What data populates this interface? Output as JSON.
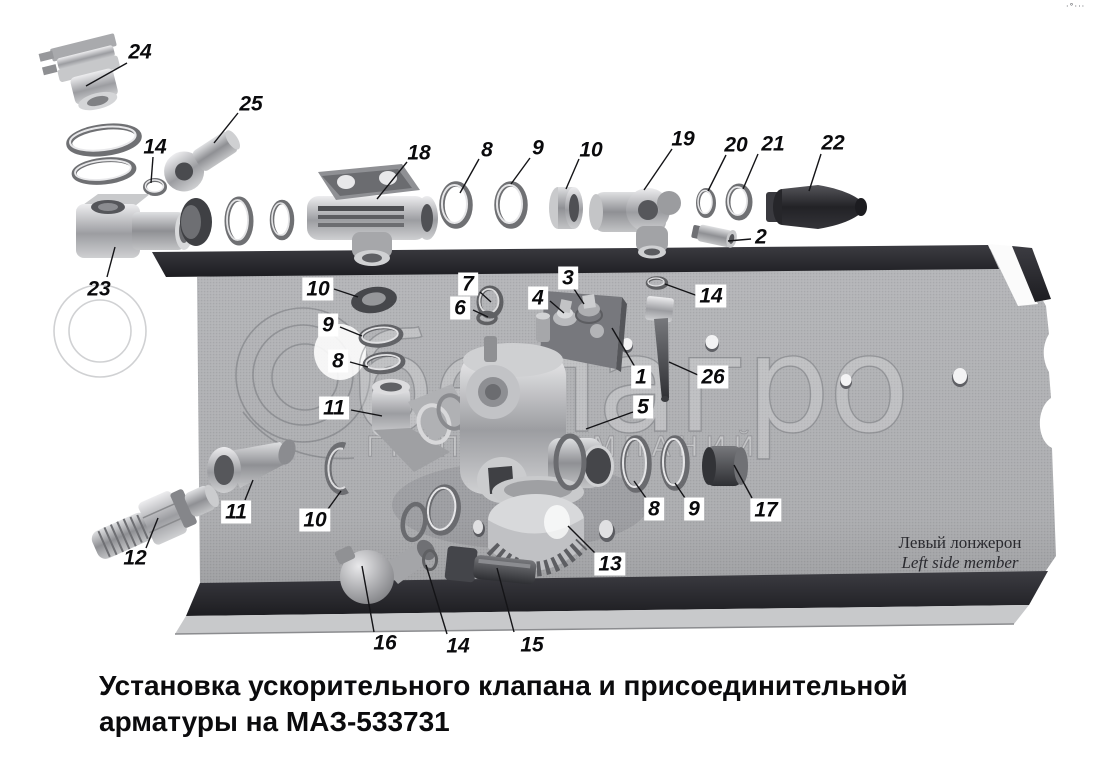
{
  "caption": {
    "line1": "Установка ускорительного клапана и присоединительной",
    "line2": "арматуры на МАЗ-533731"
  },
  "beam_label": {
    "ru": "Левый лонжерон",
    "en": "Left side member"
  },
  "watermark": {
    "brand": "белагро",
    "subtitle": "ГРУППА КОМПАНИЙ"
  },
  "corner_mark": "·°···",
  "callouts": [
    {
      "n": "24",
      "x": 140,
      "y": 52,
      "boxed": false,
      "line": [
        127,
        63,
        86,
        86
      ]
    },
    {
      "n": "25",
      "x": 251,
      "y": 104,
      "boxed": false,
      "line": [
        238,
        113,
        214,
        143
      ]
    },
    {
      "n": "14",
      "x": 155,
      "y": 147,
      "boxed": false,
      "line": [
        153,
        157,
        151,
        183
      ]
    },
    {
      "n": "23",
      "x": 99,
      "y": 289,
      "boxed": false,
      "line": [
        107,
        277,
        115,
        247
      ]
    },
    {
      "n": "18",
      "x": 419,
      "y": 153,
      "boxed": false,
      "line": [
        407,
        162,
        377,
        199
      ]
    },
    {
      "n": "8",
      "x": 487,
      "y": 150,
      "boxed": false,
      "line": [
        479,
        159,
        460,
        193
      ]
    },
    {
      "n": "9",
      "x": 538,
      "y": 148,
      "boxed": false,
      "line": [
        530,
        158,
        511,
        184
      ]
    },
    {
      "n": "10",
      "x": 591,
      "y": 150,
      "boxed": false,
      "line": [
        579,
        159,
        566,
        189
      ]
    },
    {
      "n": "19",
      "x": 683,
      "y": 139,
      "boxed": false,
      "line": [
        672,
        149,
        644,
        190
      ]
    },
    {
      "n": "20",
      "x": 736,
      "y": 145,
      "boxed": false,
      "line": [
        726,
        155,
        708,
        191
      ]
    },
    {
      "n": "21",
      "x": 773,
      "y": 144,
      "boxed": false,
      "line": [
        758,
        154,
        743,
        189
      ]
    },
    {
      "n": "22",
      "x": 833,
      "y": 143,
      "boxed": false,
      "line": [
        821,
        154,
        809,
        191
      ]
    },
    {
      "n": "2",
      "x": 761,
      "y": 237,
      "boxed": false,
      "line": [
        751,
        239,
        728,
        241
      ]
    },
    {
      "n": "12",
      "x": 135,
      "y": 558,
      "boxed": false,
      "line": [
        146,
        548,
        158,
        518
      ]
    },
    {
      "n": "16",
      "x": 385,
      "y": 643,
      "boxed": false,
      "line": [
        374,
        632,
        362,
        566
      ]
    },
    {
      "n": "14",
      "x": 458,
      "y": 646,
      "boxed": false,
      "line": [
        447,
        634,
        426,
        565
      ]
    },
    {
      "n": "15",
      "x": 532,
      "y": 645,
      "boxed": false,
      "line": [
        514,
        632,
        497,
        568
      ]
    },
    {
      "n": "10",
      "x": 318,
      "y": 289,
      "boxed": true,
      "line": [
        334,
        289,
        358,
        297
      ]
    },
    {
      "n": "9",
      "x": 328,
      "y": 325,
      "boxed": true,
      "line": [
        340,
        327,
        362,
        336
      ]
    },
    {
      "n": "8",
      "x": 338,
      "y": 361,
      "boxed": true,
      "line": [
        350,
        362,
        368,
        367
      ]
    },
    {
      "n": "11",
      "x": 334,
      "y": 408,
      "boxed": true,
      "line": [
        351,
        410,
        382,
        416
      ]
    },
    {
      "n": "7",
      "x": 468,
      "y": 284,
      "boxed": true,
      "line": [
        480,
        292,
        491,
        302
      ]
    },
    {
      "n": "6",
      "x": 460,
      "y": 308,
      "boxed": true,
      "line": [
        473,
        310,
        488,
        317
      ]
    },
    {
      "n": "3",
      "x": 568,
      "y": 278,
      "boxed": true,
      "line": [
        574,
        289,
        584,
        304
      ]
    },
    {
      "n": "4",
      "x": 538,
      "y": 298,
      "boxed": true,
      "line": [
        550,
        301,
        564,
        313
      ]
    },
    {
      "n": "14",
      "x": 711,
      "y": 296,
      "boxed": true,
      "line": [
        698,
        296,
        665,
        284
      ]
    },
    {
      "n": "1",
      "x": 641,
      "y": 377,
      "boxed": true,
      "line": [
        635,
        367,
        612,
        328
      ]
    },
    {
      "n": "26",
      "x": 713,
      "y": 377,
      "boxed": true,
      "line": [
        698,
        375,
        669,
        362
      ]
    },
    {
      "n": "5",
      "x": 643,
      "y": 407,
      "boxed": true,
      "line": [
        633,
        412,
        586,
        429
      ]
    },
    {
      "n": "11",
      "x": 236,
      "y": 512,
      "boxed": true,
      "line": [
        245,
        500,
        253,
        480
      ]
    },
    {
      "n": "10",
      "x": 315,
      "y": 520,
      "boxed": true,
      "line": [
        328,
        509,
        341,
        491
      ]
    },
    {
      "n": "13",
      "x": 610,
      "y": 564,
      "boxed": true,
      "line": [
        597,
        555,
        568,
        526
      ]
    },
    {
      "n": "8",
      "x": 654,
      "y": 509,
      "boxed": true,
      "line": [
        646,
        498,
        634,
        481
      ]
    },
    {
      "n": "9",
      "x": 694,
      "y": 509,
      "boxed": true,
      "line": [
        685,
        498,
        675,
        483
      ]
    },
    {
      "n": "17",
      "x": 766,
      "y": 510,
      "boxed": true,
      "line": [
        752,
        498,
        734,
        465
      ]
    }
  ]
}
